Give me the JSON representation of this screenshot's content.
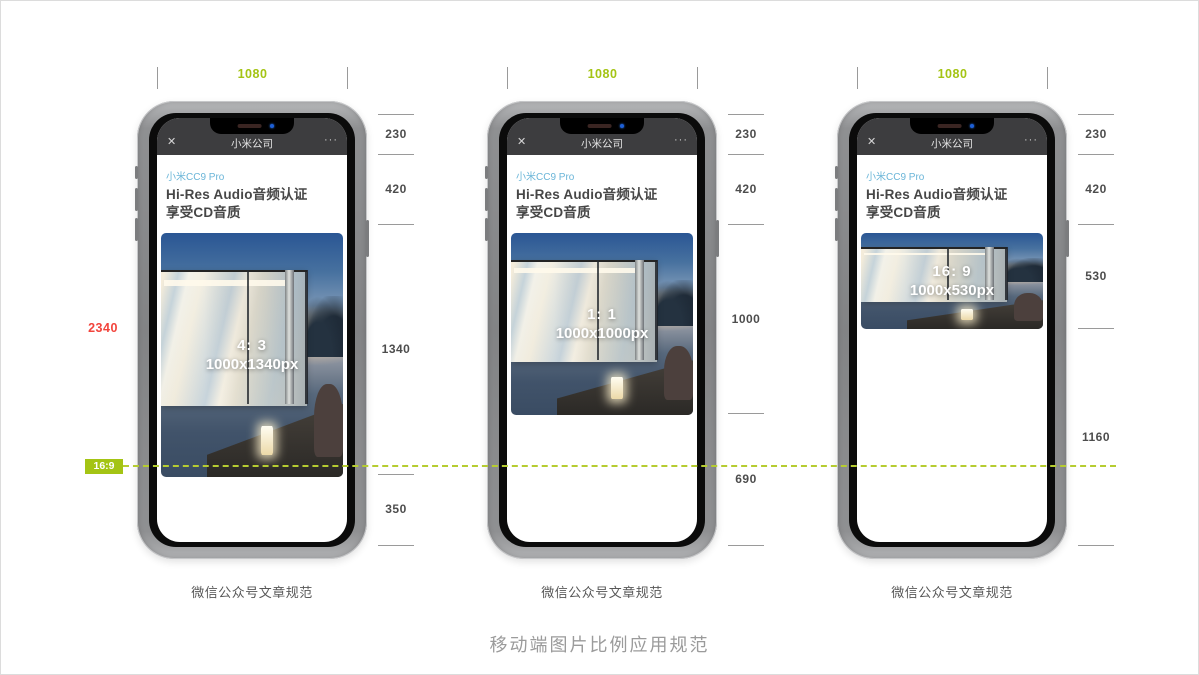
{
  "page": {
    "title": "移动端图片比例应用规范"
  },
  "annotations": {
    "screen_height": "2340",
    "ratio_chip": "16:9"
  },
  "colors": {
    "accent_green": "#a4c414",
    "accent_red": "#f2443c",
    "brand_teal": "#6ab5d8",
    "wechat_header": "#3d3d3f"
  },
  "wechat": {
    "close": "✕",
    "nav_title": "小米公司",
    "more": "···",
    "brand": "小米CC9 Pro",
    "headline1": "Hi-Res Audio音频认证",
    "headline2": "享受CD音质"
  },
  "phones": [
    {
      "width_label": "1080",
      "ratio": "4: 3",
      "size": "1000x1340px",
      "dims": [
        "230",
        "420",
        "1340",
        "350"
      ],
      "caption": "微信公众号文章规范"
    },
    {
      "width_label": "1080",
      "ratio": "1: 1",
      "size": "1000x1000px",
      "dims": [
        "230",
        "420",
        "1000",
        "690"
      ],
      "caption": "微信公众号文章规范"
    },
    {
      "width_label": "1080",
      "ratio": "16: 9",
      "size": "1000x530px",
      "dims": [
        "230",
        "420",
        "530",
        "1160"
      ],
      "caption": "微信公众号文章规范"
    }
  ]
}
